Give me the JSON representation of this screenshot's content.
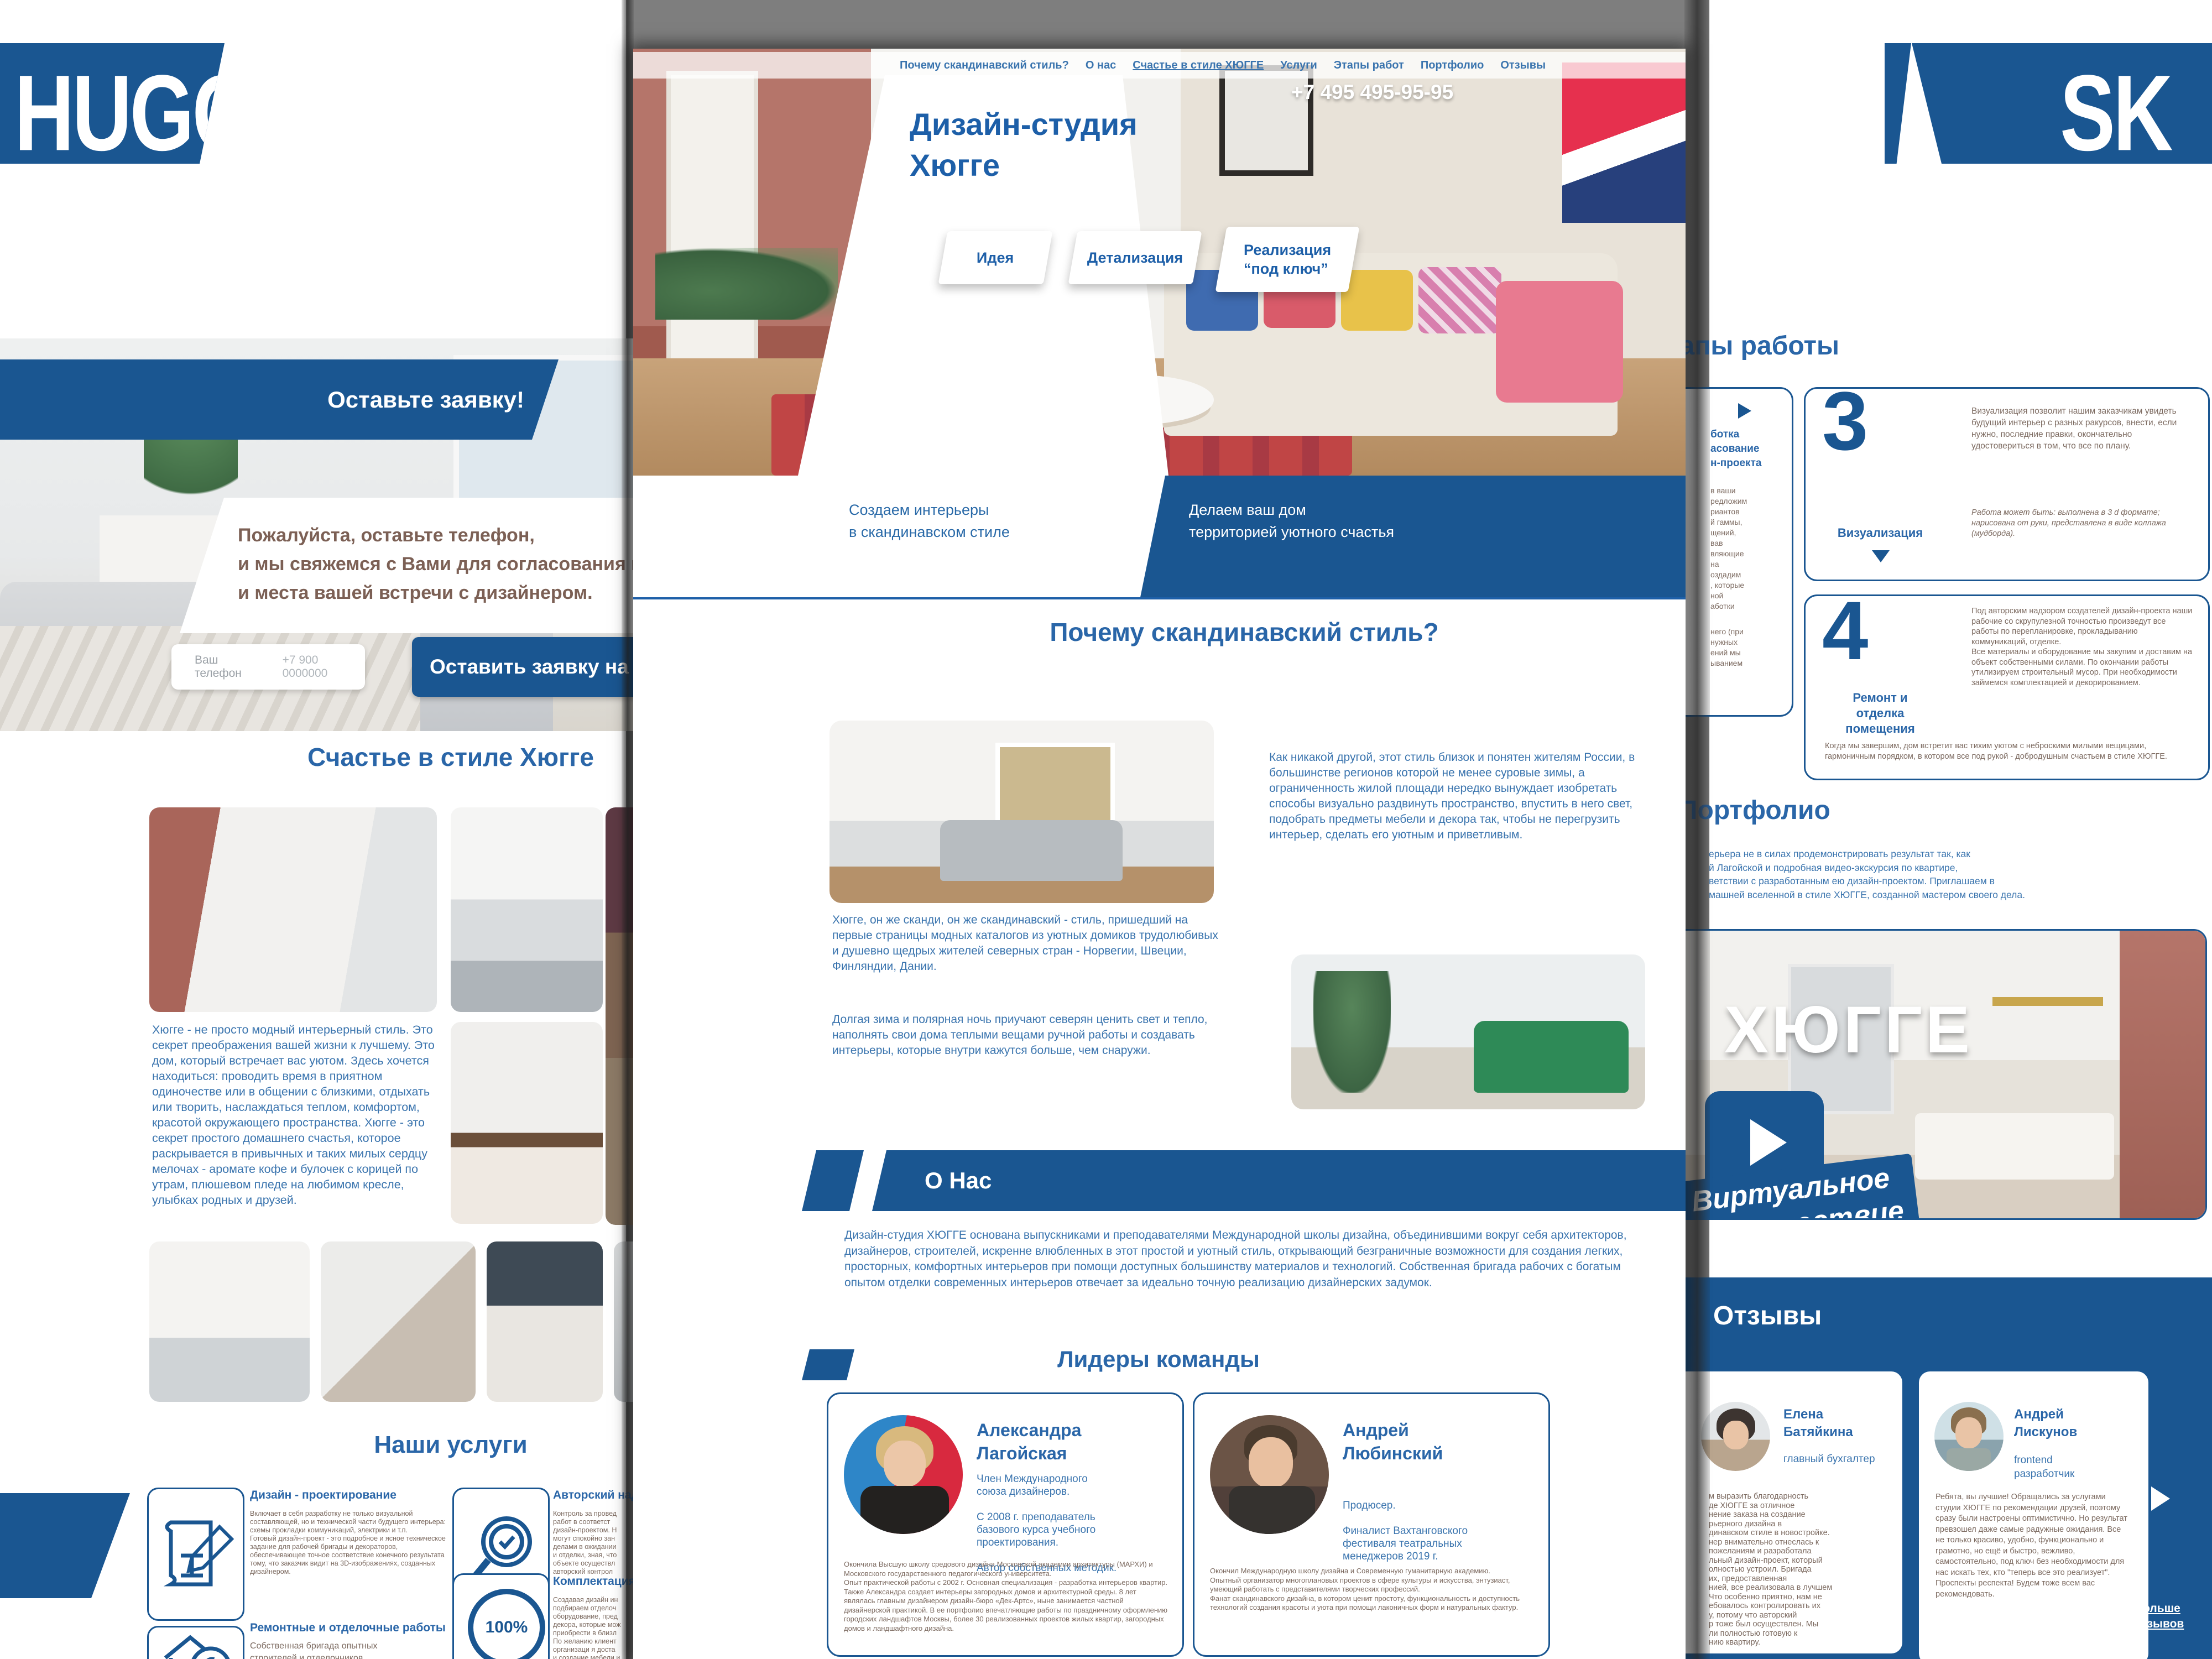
{
  "logos": {
    "left": "HUGGE",
    "right": "SK"
  },
  "colors": {
    "primary_blue": "#1a5691",
    "heading_blue": "#2a66a8",
    "body_blue": "#3a74ae",
    "body_brown": "#7c6a60",
    "white": "#ffffff"
  },
  "center_page": {
    "nav": {
      "items": [
        {
          "label": "Почему скандинавский стиль?"
        },
        {
          "label": "О нас"
        },
        {
          "label": "Счастье в стиле ХЮГГЕ"
        },
        {
          "label": "Услуги"
        },
        {
          "label": "Этапы работ"
        },
        {
          "label": "Портфолио"
        },
        {
          "label": "Отзывы"
        }
      ]
    },
    "hero": {
      "phone": "+7 495  495-95-95",
      "title": "Дизайн-студия\nХюгге",
      "buttons": [
        {
          "label": "Идея"
        },
        {
          "label": "Детализация"
        },
        {
          "label": "Реализация\n“под ключ”"
        }
      ],
      "banner_left": "Создаем интерьеры\nв скандинавском стиле",
      "banner_right": "Делаем ваш дом\nтерриторией уютного счастья"
    },
    "why": {
      "heading": "Почему скандинавский стиль?",
      "text_right": "Как никакой другой, этот стиль близок и понятен жителям России, в большинстве регионов которой не менее суровые зимы, а ограниченность жилой площади нередко вынуждает изобретать способы визуально раздвинуть пространство, впустить в него свет, подобрать предметы мебели и декора так, чтобы не перегрузить интерьер, сделать его уютным и приветливым.",
      "text_left_1": "Хюгге, он же сканди, он же скандинавский - стиль, пришедший на первые страницы модных каталогов из уютных домиков трудолюбивых и душевно щедрых жителей северных стран - Норвегии, Швеции, Финляндии, Дании.",
      "text_left_2": "Долгая зима и полярная ночь приучают северян ценить свет и тепло, наполнять свои дома теплыми вещами ручной работы и создавать интерьеры, которые внутри кажутся больше, чем снаружи."
    },
    "about": {
      "heading": "О Нас",
      "text": "Дизайн-студия ХЮГГЕ основана выпускниками и преподавателями Международной школы дизайна, объединившими вокруг себя архитекторов, дизайнеров, строителей, искренне влюбленных в этот простой и уютный стиль, открывающий безграничные возможности для создания легких, просторных, комфортных интерьеров при помощи доступных большинству материалов и технологий. Собственная бригада рабочих с богатым опытом отделки современных интерьеров отвечает за идеально точную реализацию дизайнерских задумок."
    },
    "team": {
      "heading": "Лидеры команды",
      "members": [
        {
          "name": "Александра\nЛагойская",
          "roles": "Член Международного\nсоюза дизайнеров.\n\nС 2008 г. преподаватель\nбазового курса учебного\nпроектирования.\n\nАвтор собственных методик.",
          "bio": "Окончила Высшую школу средового дизайна Московской академии архитектуры (МАРХИ) и Московского государственного педагогического университета.\nОпыт практической работы с 2002 г. Основная специализация - разработка интерьеров квартир.\nТакже Александра создает интерьеры загородных домов и архитектурной среды. 8 лет являлась главным дизайнером дизайн-бюро «Дек-Артс», ныне занимается частной дизайнерской практикой. В ее портфолио впечатляющие работы по праздничному оформлению городских ландшафтов Москвы, более 30 реализованных проектов жилых квартир, загородных домов и ландшафтного дизайна."
        },
        {
          "name": "Андрей\nЛюбинский",
          "roles": "Продюсер.\n\nФиналист Вахтанговского\nфестиваля театральных\nменеджеров 2019 г.",
          "bio": "Окончил Международную школу дизайна и Современную гуманитарную академию.\nОпытный организатор многоплановых проектов в сфере культуры и искусства, энтузиаст, умеющий работать с представителями творческих профессий.\nФанат скандинавского дизайна, в котором ценит простоту, функциональность и доступность технологий создания красоты и уюта при помощи лаконичных форм и натуральных фактур."
        }
      ]
    }
  },
  "left_page": {
    "request_banner": "Оставьте заявку!",
    "message": "Пожалуйста, оставьте телефон,\nи мы свяжемся с Вами для согласования времени\nи места вашей встречи с дизайнером.",
    "phone_input": {
      "label": "Ваш телефон",
      "placeholder": "+7 900 0000000"
    },
    "submit_label": "Оставить заявку на",
    "happiness": {
      "heading": "Счастье в стиле Хюгге",
      "text": "Хюгге - не просто модный интерьерный стиль. Это секрет преображения вашей жизни к лучшему. Это дом, который встречает вас уютом. Здесь хочется находиться: проводить время в приятном одиночестве или в общении с близкими, отдыхать или творить, наслаждаться теплом, комфортом, красотой окружающего пространства. Хюгге - это секрет простого домашнего счастья, которое раскрывается в привычных и таких милых сердцу мелочах - аромате кофе и булочек с корицей по утрам, плюшевом пледе на любимом кресле, улыбках родных и друзей."
    },
    "services": {
      "heading": "Наши услуги",
      "items": [
        {
          "title": "Дизайн - проектирование",
          "text": "Включает в себя разработку не только визуальной составляющей, но и технической части будущего интерьера:\nсхемы прокладки коммуникаций, электрики и т.п.\nГотовый дизайн-проект - это подробное и ясное техническое задание для рабочей бригады и декораторов, обеспечивающее точное соответствие конечного результата тому, что заказчик видит на 3D-изображениях, созданных дизайнером."
        },
        {
          "title": "Авторский надзор",
          "text": "Контроль за провед\nработ в соответст\nдизайн-проектом. Н\nмогут спокойно зан\nделами в ожидании\nи отделки, зная, что\nобъекте осуществл\nавторский контрол"
        },
        {
          "title": "Ремонтные и отделочные работы",
          "text": "Собственная бригада опытных\nстроителей и отделочников"
        },
        {
          "title": "Комплектация пр",
          "text": "Создавая дизайн ин\nподбираем отделоч\nоборудование, пред\nдекора, которые мож\nприобрести в близл\nПо желанию клиент\nорганизаци я доста\nи создание мебели и",
          "badge": "100%"
        }
      ]
    }
  },
  "right_page": {
    "stages": {
      "heading": "Этапы работы",
      "stage2_fragments": {
        "title": "ботка\nасование\nн-проекта",
        "body": "в ваши\nредложим\nриантов\nй гаммы,\nщений,\nвав\nвляющие\nна\nоздадим\n, которые\nной\nаботки",
        "body2": "него (при\nнужных\nений мы\nыванием"
      },
      "stage3": {
        "number": "3",
        "label": "Визуализация",
        "text": "Визуализация  позволит  нашим заказчикам увидеть будущий интерьер с разных ракурсов, внести, если нужно, последние правки, окончательно удостовериться в том, что все по плану.",
        "note": "Работа  может быть: выполнена в 3 d формате; нарисована от руки, представлена в виде коллажа (мудборда)."
      },
      "stage4": {
        "number": "4",
        "label": "Ремонт и\nотделка\nпомещения",
        "text": "Под авторским надзором создателей дизайн-проекта наши рабочие со скрупулезной точностью произведут все работы по перепланировке, прокладыванию коммуникаций, отделке.\nВсе материалы и оборудование мы закупим и доставим на объект собственными силами. По окончании работы утилизируем строительный мусор. При необходимости займемся комплектацией и декорированием.",
        "outro": "Когда мы завершим, дом встретит вас тихим уютом с неброскими милыми вещицами, гармоничным порядком, в котором все под рукой - добродушным счастьем в стиле ХЮГГЕ."
      }
    },
    "portfolio": {
      "heading": "Портфолио",
      "intro_fragments": "ерьера не в силах продемонстрировать результат так, как\nй Лагойской и подробная видео-экскурсия по квартире,\nветствии с разработанным ею дизайн-проектом. Приглашаем в\nмашней вселенной в стиле ХЮГГЕ, созданной мастером своего дела.",
      "video": {
        "title": "ХЮГГЕ",
        "ribbon": "Виртуальное\nпутешествие"
      }
    },
    "reviews": {
      "heading": "Отзывы",
      "items": [
        {
          "name": "Елена\nБатяйкина",
          "role": "главный бухгалтер",
          "text": "м выразить благодарность\nде ХЮГГЕ за отличное\nнение заказа на создание\nрьерного дизайна в\nдинавском стиле в новостройке.\nнер внимательно отнеслась к\nпожеланиям и разработала\nльный дизайн-проект, который\nолностью устроил. Бригада\nих, предоставленная\nнией, все реализовала в лучшем\nЧто особенно приятно, нам не\nебовалось контролировать их\nу, потому что авторский\nр тоже был осуществлен. Мы\nли полностью готовую к\nнию квартиру."
        },
        {
          "name": "Андрей\nЛискунов",
          "role": "frontend\nразработчик",
          "text": "Ребята, вы лучшие! Обращались за услугами студии ХЮГГЕ по рекомендации друзей, поэтому сразу были настроены оптимистично. Но результат превзошел даже самые радужные ожидания. Все не только красиво, удобно, функционально и грамотно, но ещё и быстро, вежливо, самостоятельно, под ключ без необходимости для нас искать тех, кто \"теперь все это реализует\". Проспекты респекта! Будем тоже всем вас рекомендовать."
        }
      ],
      "more_label": "Больше\nотзывов"
    }
  }
}
